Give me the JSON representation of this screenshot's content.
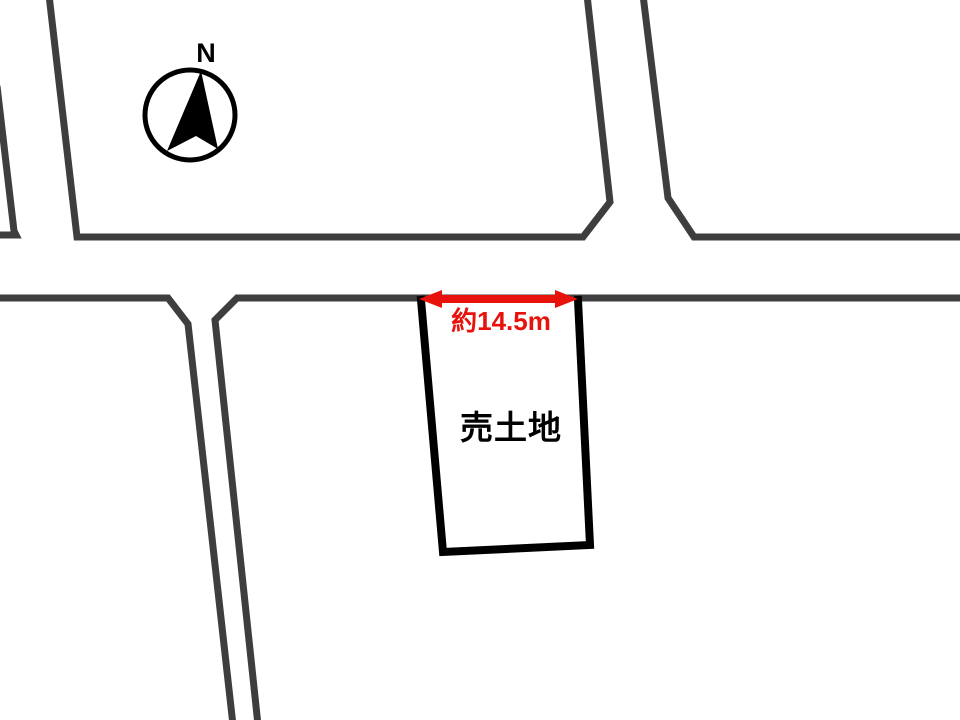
{
  "compass": {
    "north_label": "N"
  },
  "land_plot": {
    "label": "売土地"
  },
  "dimension": {
    "label": "約14.5m"
  },
  "colors": {
    "background": "#ffffff",
    "road_line": "#3e3e3e",
    "plot_outline": "#000000",
    "label_text": "#000000",
    "dimension_accent": "#e8120c"
  }
}
